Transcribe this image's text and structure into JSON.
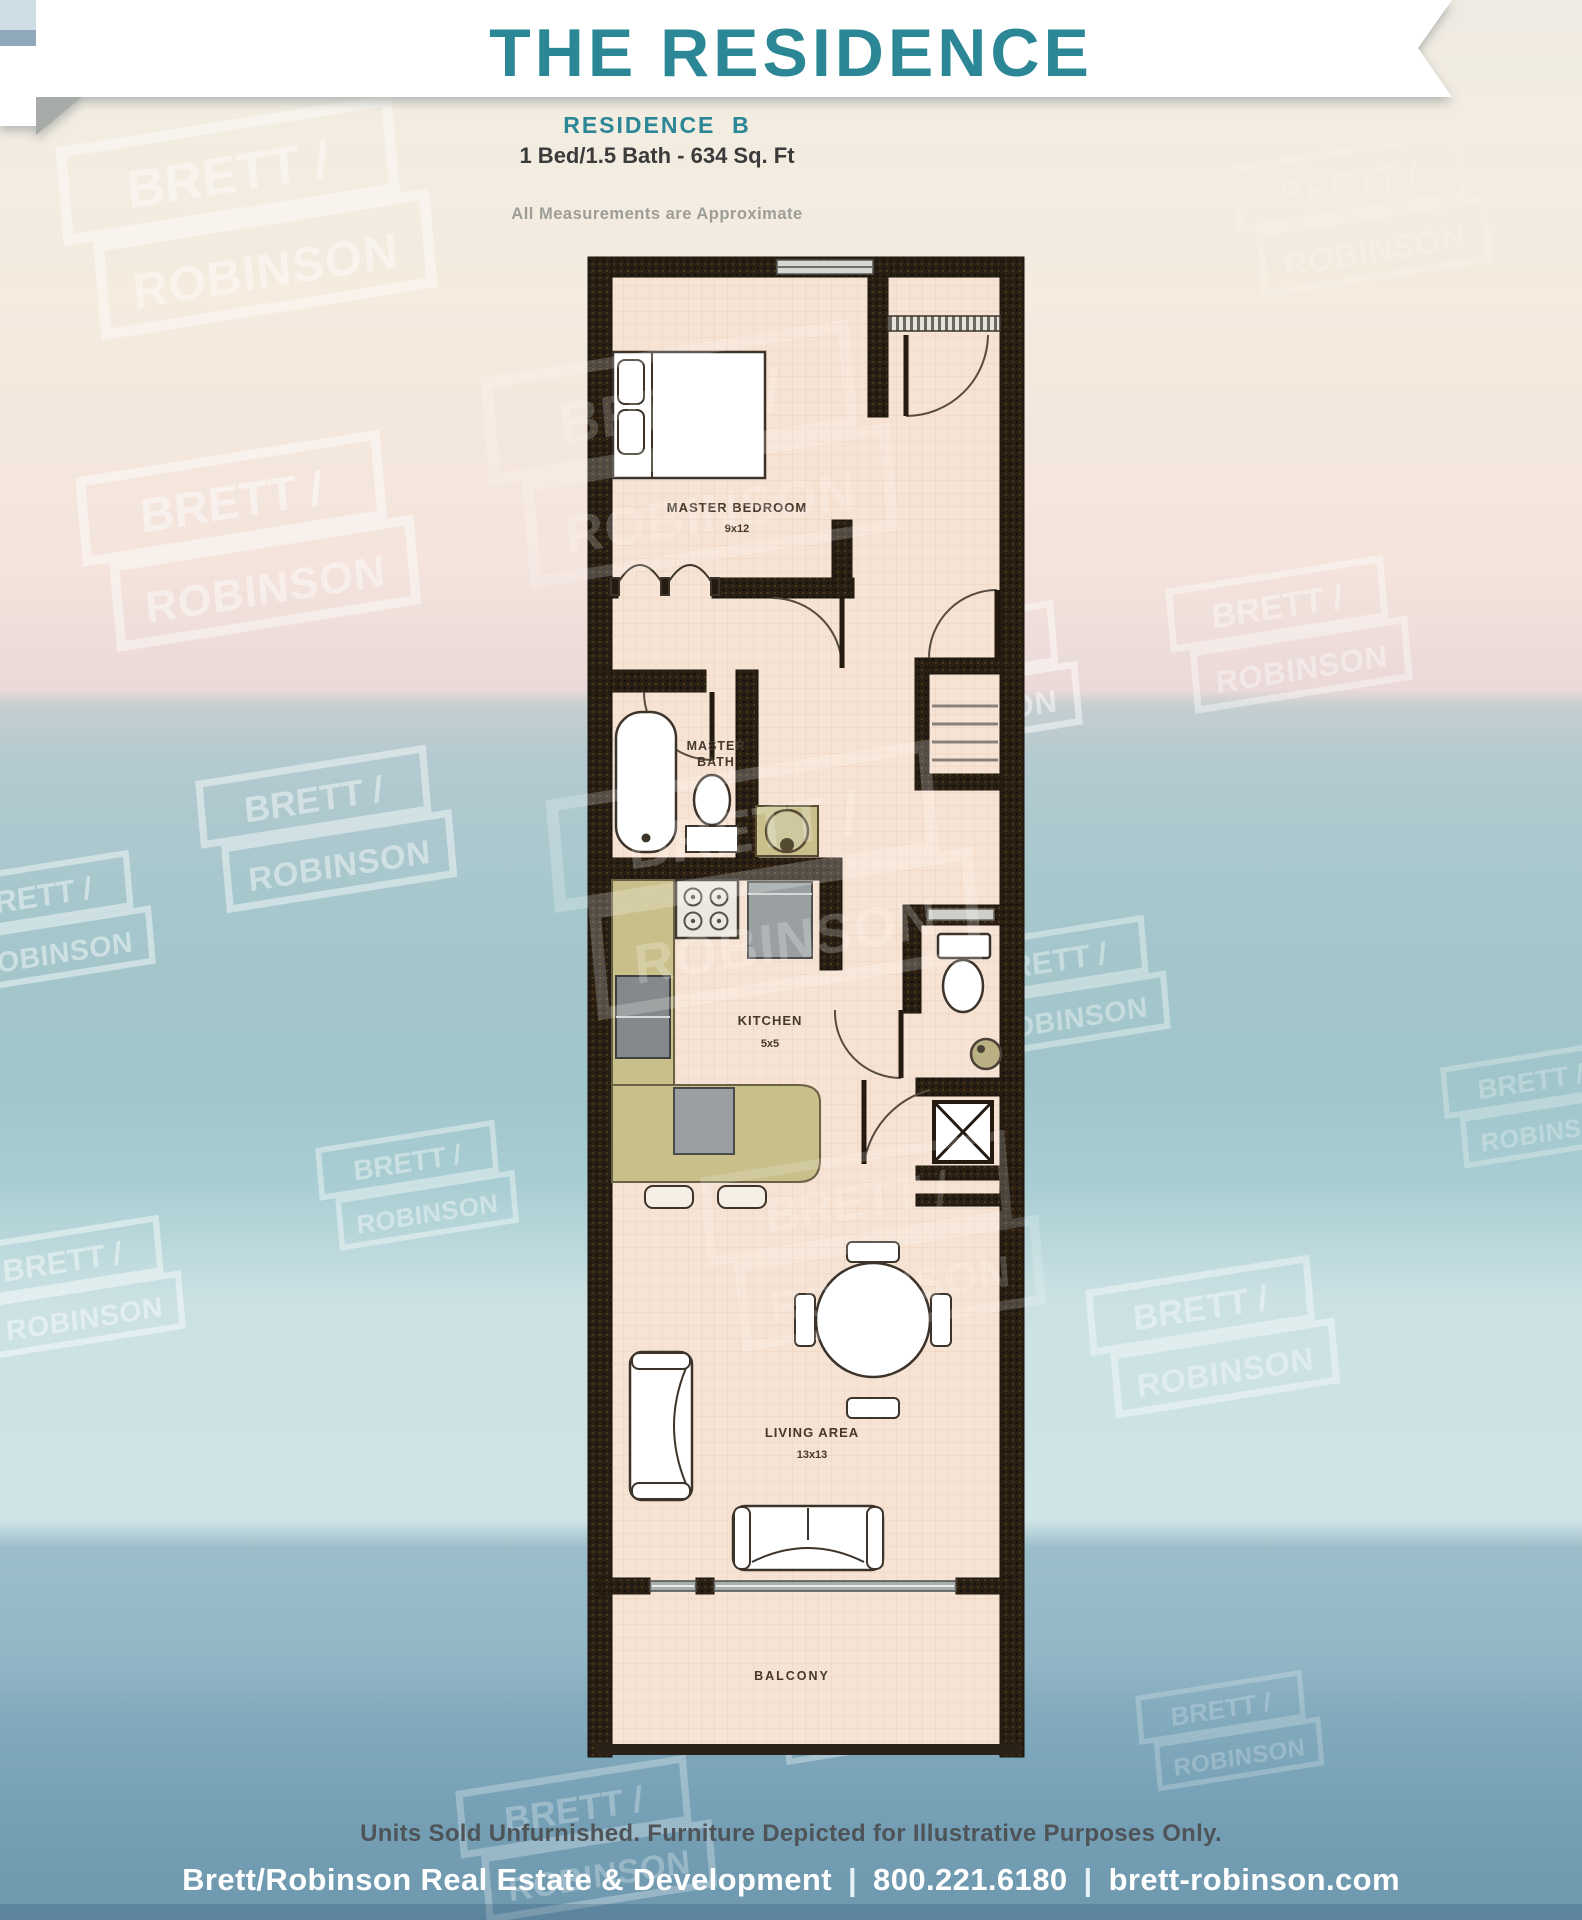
{
  "header": {
    "title": "THE RESIDENCE"
  },
  "plan_info": {
    "residence": "RESIDENCE  B",
    "specs": "1 Bed/1.5 Bath - 634 Sq. Ft",
    "note": "All Measurements are Approximate"
  },
  "floorplan": {
    "master_bedroom": {
      "label": "MASTER BEDROOM",
      "dims": "9x12"
    },
    "master_bath": {
      "label_line1": "MASTER",
      "label_line2": "BATH"
    },
    "kitchen": {
      "label": "KITCHEN",
      "dims": "5x5"
    },
    "living_area": {
      "label": "LIVING AREA",
      "dims": "13x13"
    },
    "balcony": {
      "label": "BALCONY"
    }
  },
  "watermark": {
    "line1": "BRETT /",
    "line2": "ROBINSON"
  },
  "footer": {
    "disclaimer": "Units Sold Unfurnished. Furniture Depicted for Illustrative Purposes Only.",
    "company": "Brett/Robinson Real Estate & Development",
    "phone": "800.221.6180",
    "website": "brett-robinson.com",
    "separator": "|"
  },
  "colors": {
    "teal": "#2b8795",
    "wall": "#2a1f12",
    "floor": "#f6e3d3",
    "counter": "#c9bf8a",
    "ocean": "#9fc4cc"
  }
}
